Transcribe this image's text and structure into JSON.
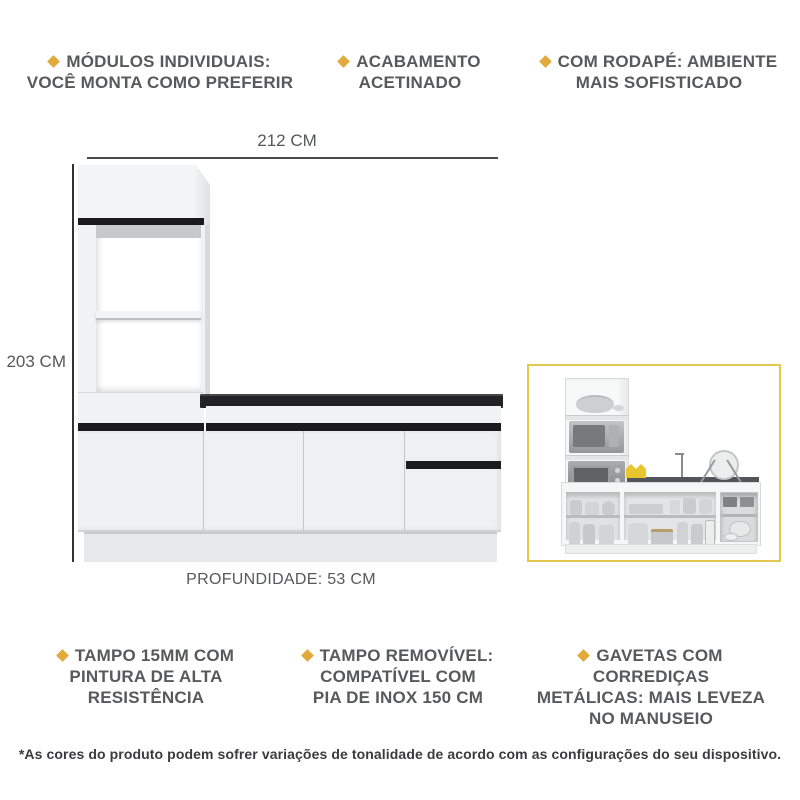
{
  "features_top": [
    {
      "lines": [
        "MÓDULOS INDIVIDUAIS:",
        "VOCÊ MONTA COMO PREFERIR"
      ]
    },
    {
      "lines": [
        "ACABAMENTO",
        "ACETINADO"
      ]
    },
    {
      "lines": [
        "COM RODAPÉ: AMBIENTE",
        "MAIS SOFISTICADO"
      ]
    }
  ],
  "features_bottom": [
    {
      "lines": [
        "TAMPO 15MM COM",
        "PINTURA DE ALTA",
        "RESISTÊNCIA"
      ]
    },
    {
      "lines": [
        "TAMPO REMOVÍVEL:",
        "COMPATÍVEL COM",
        "PIA DE INOX 150 CM"
      ]
    },
    {
      "lines": [
        "GAVETAS COM CORREDIÇAS",
        "METÁLICAS: MAIS LEVEZA",
        "NO MANUSEIO"
      ]
    }
  ],
  "dimensions": {
    "width_label": "212 CM",
    "height_label": "203 CM",
    "depth_label": "PROFUNDIDADE: 53 CM"
  },
  "footer": {
    "disclaimer": "*As cores do produto podem sofrer variações de tonalidade de acordo com as configurações do seu dispositivo."
  },
  "colors": {
    "accent_gold": "#e2a93b",
    "feature_text_gray": "#58595b",
    "footer_text": "#3b3b3d",
    "black_accent": "#1b1b1d",
    "inset_border_yellow": "#e2c94e"
  }
}
